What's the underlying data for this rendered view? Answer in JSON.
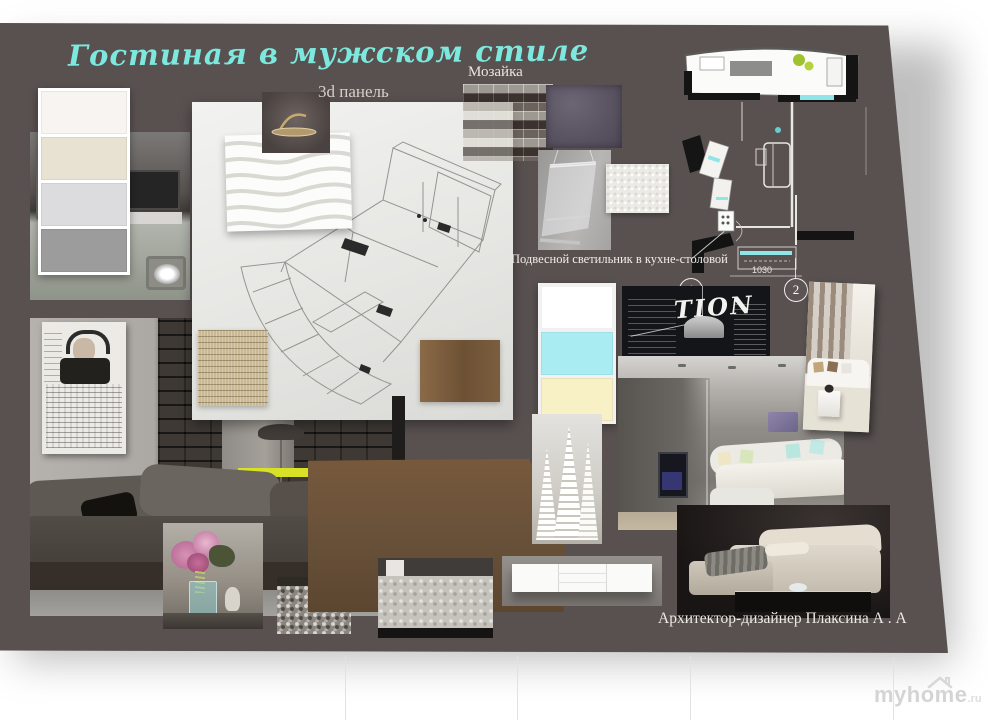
{
  "board": {
    "title": "Гостиная в мужском стиле",
    "bg_color": "#585150",
    "title_color": "#7de8de"
  },
  "labels": {
    "panel_3d": "3d панель",
    "mosaic": "Мозайка",
    "pendant_light": "Подвесной светильник в кухне-столовой",
    "signature": "Архитектор-дизайнер Плаксина А . А"
  },
  "palettes": {
    "main": [
      "#f8f4f1",
      "#e7e2d1",
      "#dcdcde",
      "#9c9c9c"
    ],
    "accent": [
      "#ffffff",
      "#a9ecf1",
      "#f8f1c5"
    ]
  },
  "floor_plan": {
    "markers": [
      {
        "label": "1"
      },
      {
        "label": "2"
      }
    ],
    "dimension": "1030"
  },
  "chalkboard": {
    "graffiti_fragment": "TION"
  },
  "materials": {
    "wood_hex": "#6a523a",
    "chartreuse_bar_hex": "#d8e125",
    "mosaic_dark_tile_hex": "#5a5462",
    "plan_accent_cyan": "#8fe5e8"
  },
  "watermark": {
    "text": "myhome",
    "suffix": ".ru"
  }
}
